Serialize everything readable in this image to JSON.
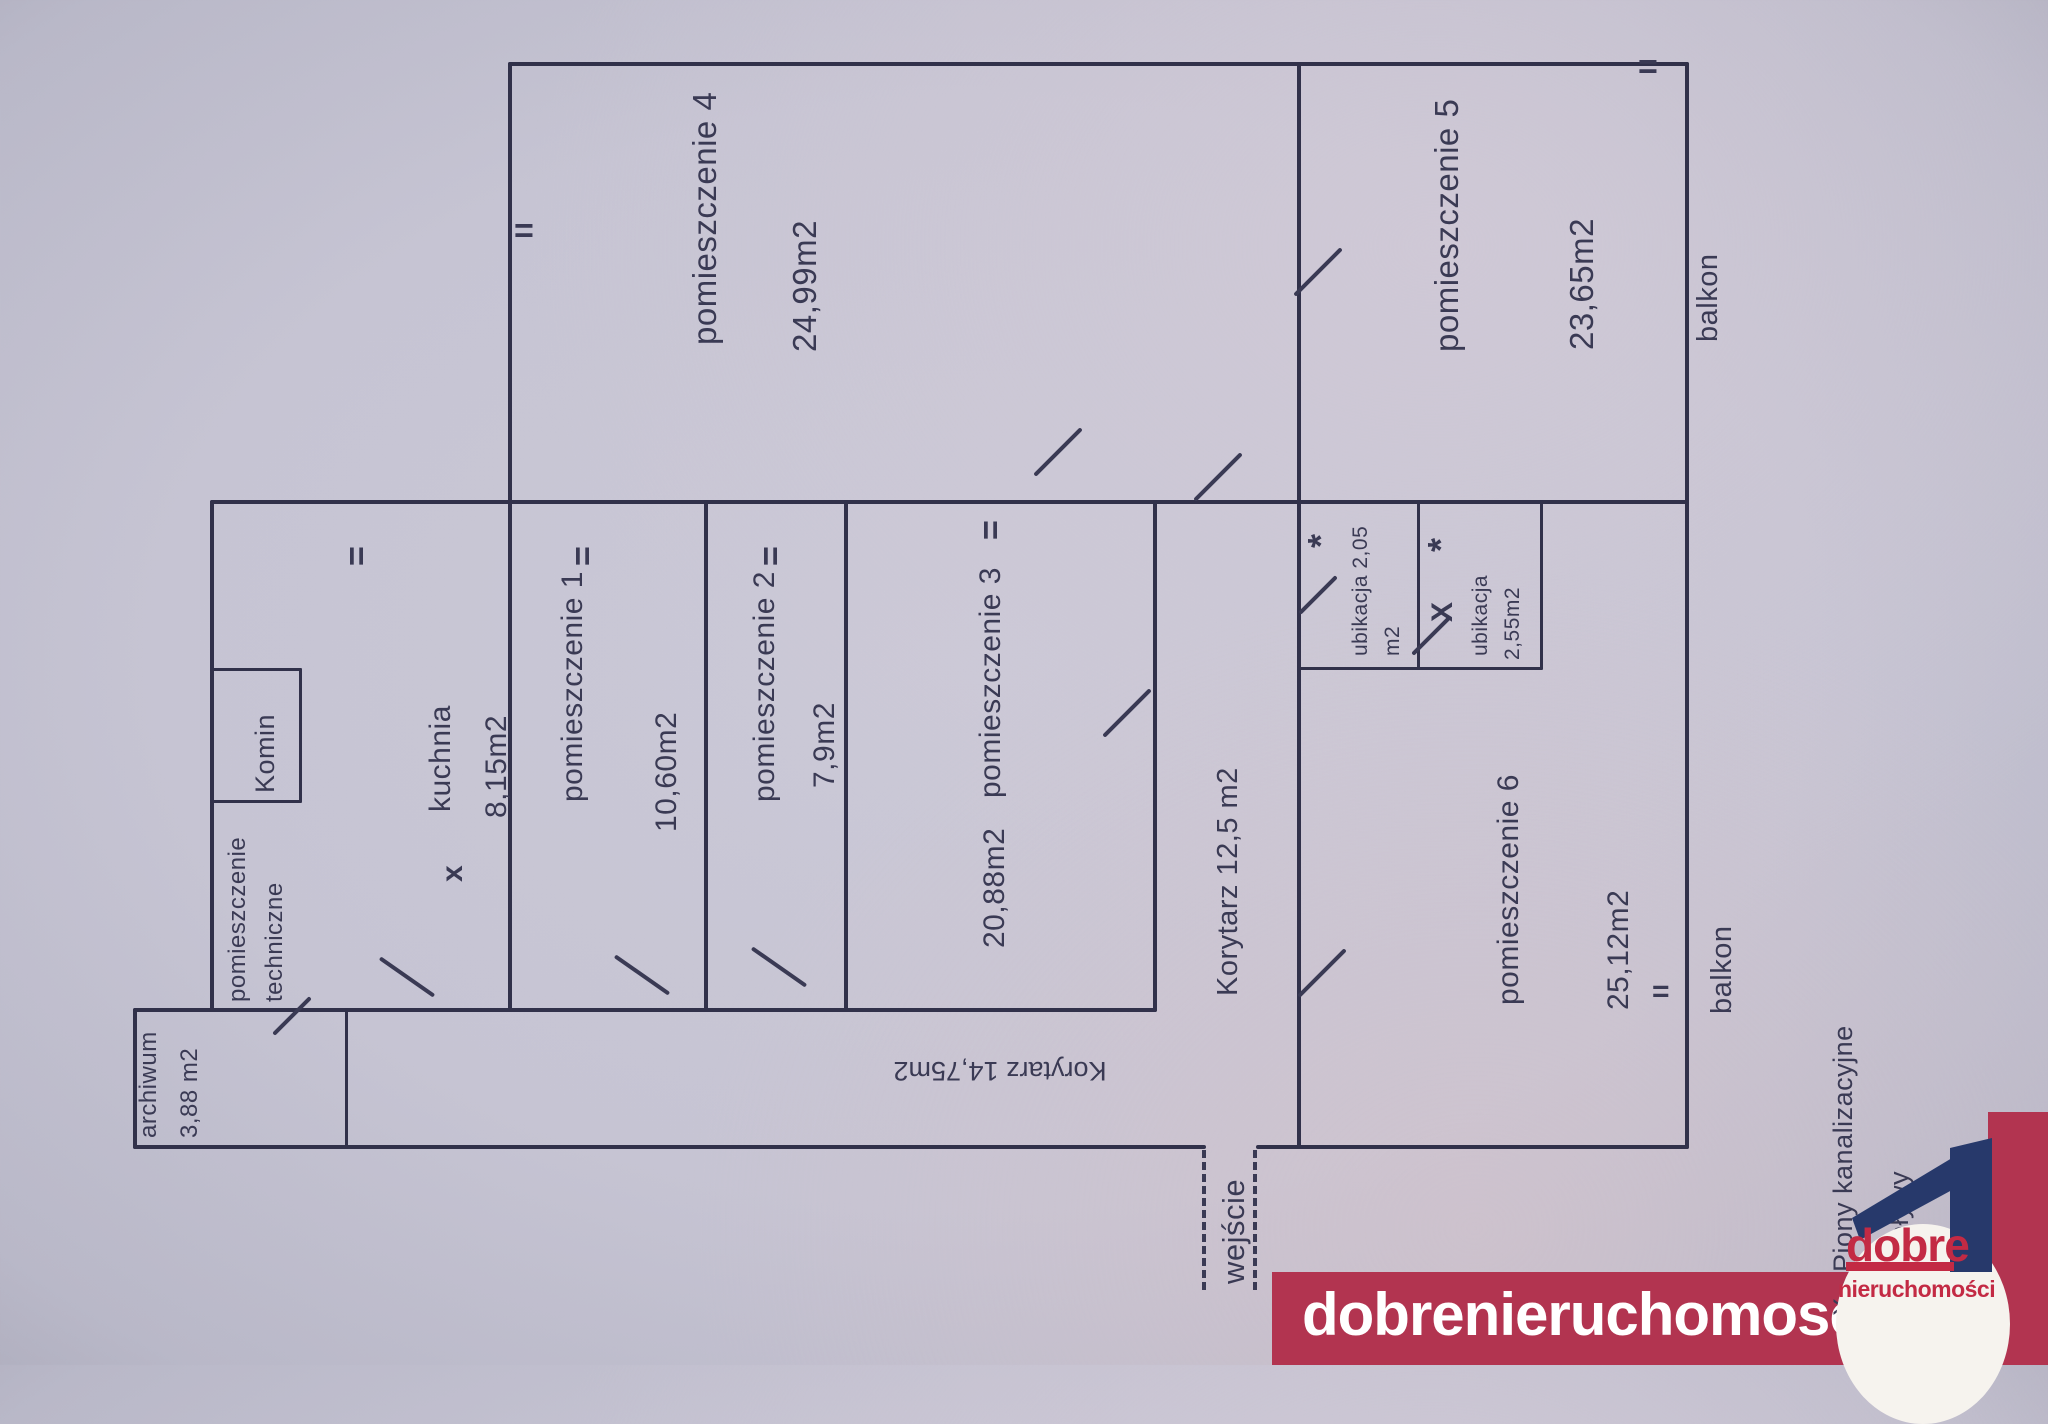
{
  "document": {
    "kind": "floor plan photo",
    "language": "pl"
  },
  "rooms": {
    "pom_techniczne_l1": "pomieszczenie",
    "pom_techniczne_l2": "techniczne",
    "komin": "Komin",
    "kuchnia": "kuchnia",
    "kuchnia_area": "8,15m2",
    "pom1": "pomieszczenie 1",
    "pom1_area": "10,60m2",
    "pom2": "pomieszczenie 2",
    "pom2_area": "7,9m2",
    "pom3": "pomieszczenie 3",
    "pom3_area": "20,88m2",
    "pom4": "pomieszczenie 4",
    "pom4_area": "24,99m2",
    "pom5": "pomieszczenie 5",
    "pom5_area": "23,65m2",
    "pom6": "pomieszczenie 6",
    "pom6_area": "25,12m2",
    "ubikacja1_l1": "ubikacja 2,05",
    "ubikacja1_l2": "m2",
    "ubikacja2_l1": "ubikacja",
    "ubikacja2_l2": "2,55m2",
    "archiwum": "archiwum",
    "archiwum_area": "3,88 m2",
    "korytarz_poziomy": "Korytarz 14,75m2",
    "korytarz_pionowy": "Korytarz 12,5 m2",
    "wejscie": "wejście",
    "balkon_gorny": "balkon",
    "balkon_dolny": "balkon"
  },
  "marks": {
    "window": "=",
    "door": "/",
    "x_small": "x",
    "x_big": "X",
    "asterisk": "*"
  },
  "legend": {
    "line1": "X - Piony kanalizacyjne",
    "line2": "odpływy"
  },
  "watermark": {
    "url_text": "dobrenieruchomosci.eu",
    "logo_line1": "dobre",
    "logo_line2": "nieruchomości"
  },
  "colors": {
    "paper": "#c6c4d3",
    "ink": "#31314a",
    "watermark_red": "#b23450",
    "logo_red": "#c32a44",
    "logo_navy": "#27396b"
  }
}
